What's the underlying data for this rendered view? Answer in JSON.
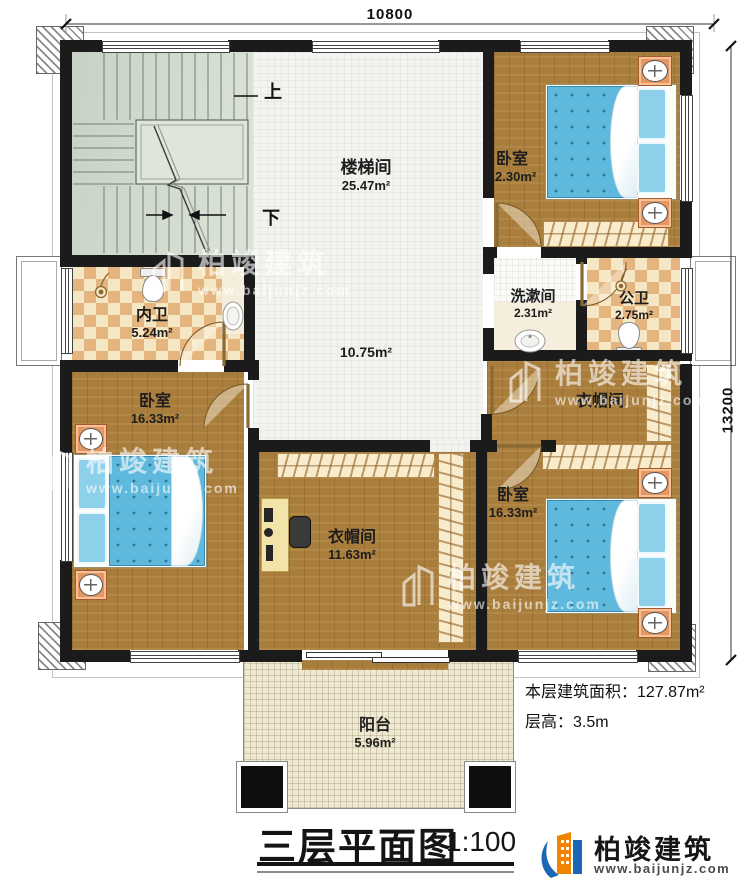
{
  "dimensions": {
    "width_mm": "10800",
    "height_mm": "13200"
  },
  "stairs": {
    "up": "上",
    "down": "下"
  },
  "rooms": {
    "stairwell": {
      "name": "楼梯间",
      "area": "25.47m²"
    },
    "hall": {
      "area": "10.75m²"
    },
    "bedroom_top_right": {
      "name": "卧室",
      "area": "12.30m²"
    },
    "inner_bathroom": {
      "name": "内卫",
      "area": "5.24m²"
    },
    "washroom": {
      "name": "洗漱间",
      "area": "2.31m²"
    },
    "public_bathroom": {
      "name": "公卫",
      "area": "2.75m²"
    },
    "cloakroom_right": {
      "name": "衣帽间"
    },
    "bedroom_left": {
      "name": "卧室",
      "area": "16.33m²"
    },
    "cloakroom_center": {
      "name": "衣帽间",
      "area": "11.63m²"
    },
    "bedroom_bottom_right": {
      "name": "卧室",
      "area": "16.33m²"
    },
    "balcony": {
      "name": "阳台",
      "area": "5.96m²"
    }
  },
  "annotations": {
    "floor_area_label": "本层建筑面积：",
    "floor_area_value": "127.87m²",
    "floor_height_label": "层高：",
    "floor_height_value": "3.5m"
  },
  "title": {
    "text": "三层平面图",
    "scale": "1:100"
  },
  "brand": {
    "name": "柏竣建筑",
    "website": "www.baijunjz.com"
  },
  "watermark": {
    "name": "柏竣建筑",
    "website": "www.baijunjz.com"
  },
  "colors": {
    "wall": "#1b1b1b",
    "wood": "#a97d3b",
    "tile_light": "#f6e7c4",
    "tile_dark": "#e5b57f",
    "bed_blue": "#5fb9dc",
    "brand_blue": "#1b67b3",
    "brand_orange": "#f08300"
  }
}
